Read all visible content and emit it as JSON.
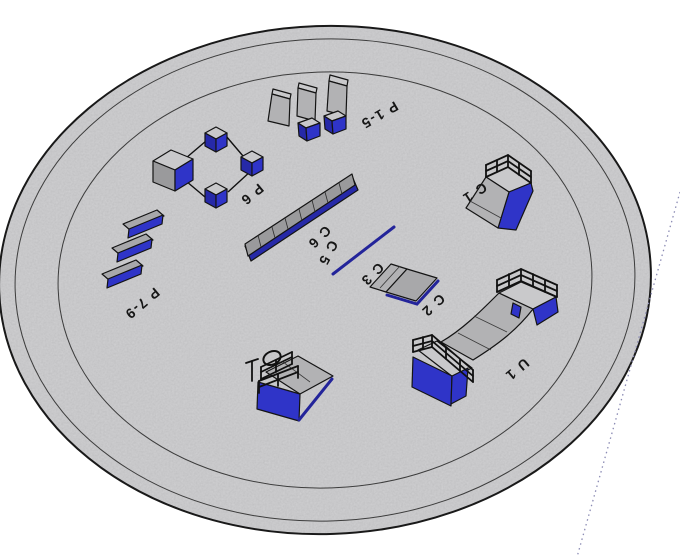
{
  "scene": {
    "background_color": "#ffffff",
    "platform_fill": "#d3d3d5",
    "module_blue": "#2f34c8",
    "edge_color": "#1a1a1a",
    "guide_line_color": "#8b8bb4"
  },
  "labels": {
    "p15": "P 1-5",
    "p6": "P 6",
    "p79": "P 7-9",
    "c6": "C 6",
    "c5": "C 5",
    "c3": "C 3",
    "c2": "C 2",
    "c1": "C 1",
    "u1": "U 1"
  },
  "objects": [
    {
      "label": "P 1-5",
      "shape": "three tall gray pillars with two blue boxes"
    },
    {
      "label": "P 6",
      "shape": "large cube linked to three small cubes"
    },
    {
      "label": "P 7-9",
      "shape": "three parallel blue bars"
    },
    {
      "label": "C 6",
      "shape": "long segmented bank ramp"
    },
    {
      "label": "C 5",
      "shape": "thin ground grind rail"
    },
    {
      "label": "C 3",
      "shape": "flat kicker panel"
    },
    {
      "label": "C 2",
      "shape": "low box ramp with blue base edge"
    },
    {
      "label": "C 1",
      "shape": "quarter ramp with top railing"
    },
    {
      "label": "U 1",
      "shape": "half-pipe with railed platforms and blue base"
    },
    {
      "label": "",
      "shape": "unlabeled wedge ramp with railing and hoop"
    }
  ]
}
